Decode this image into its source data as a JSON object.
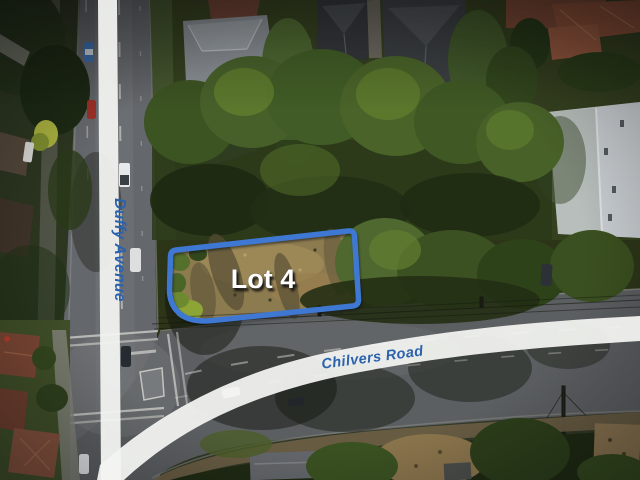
{
  "image": {
    "kind": "aerial-photo-with-map-overlays",
    "description": "Aerial view of a vacant corner land parcel at the intersection of Duffy Avenue and Chilvers Road"
  },
  "overlays": {
    "lot_label": "Lot 4",
    "streets": [
      {
        "name": "Duffy Avenue",
        "orientation": "vertical"
      },
      {
        "name": "Chilvers Road",
        "orientation": "diagonal"
      }
    ]
  },
  "colors": {
    "lot_boundary_blue": "#3f78d2",
    "street_label_blue": "#2b62ae",
    "ribbon_white": "#f3f4f1",
    "lot_label_white": "#ffffff"
  }
}
